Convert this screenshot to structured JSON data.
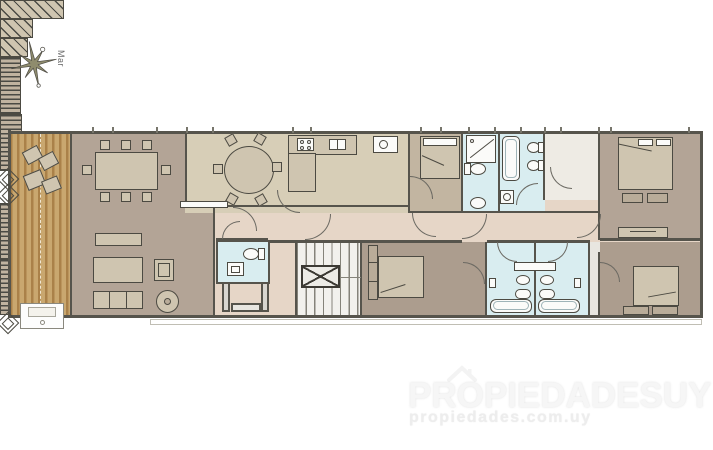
{
  "compass": {
    "label": "Mar",
    "icon": "compass-rose-icon"
  },
  "watermark": {
    "brand": "PROPIEDADESUY",
    "url": "propiedades.com.uy",
    "icon": "house-roof-icon"
  },
  "palette": {
    "wall": "#56544c",
    "line": "#4c4a42",
    "arcline": "#6b6962",
    "deck-wood-a": "#c9a76f",
    "deck-wood-b": "#aa8149",
    "floor-living": "#b3a496",
    "floor-khaki": "#d7ceb7",
    "floor-hall": "#e6d6c7",
    "floor-bath": "#d9edf0",
    "floor-bedroom": "#ac9d8e",
    "floor-bedroom-small": "#c2b5a1",
    "floor-stair": "#f2f1ed",
    "floor-wic": "#eeebe4",
    "furniture-light": "#cfc5b0",
    "furniture-mid": "#b9ac99",
    "fixture-white": "#fbfbf9",
    "closet-stripe": "#4a4a44",
    "closet-bg": "#c0b3a0",
    "compass-fill": "#8f8c6d",
    "watermark-text": "#f6f6f6",
    "watermark-sub": "#ededed"
  }
}
